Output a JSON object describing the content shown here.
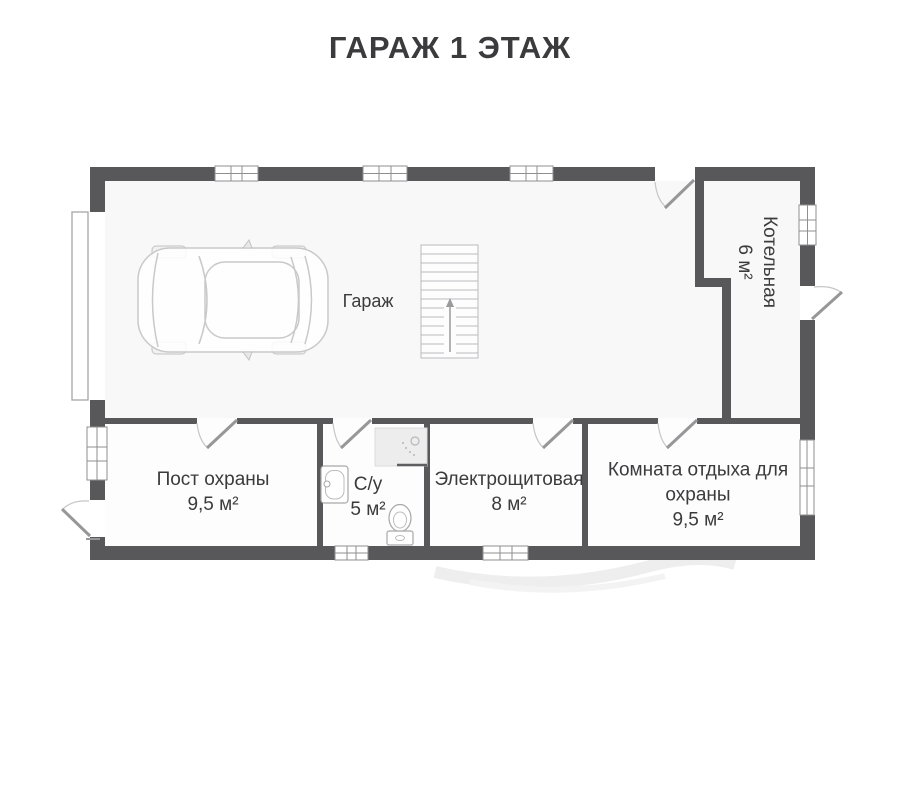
{
  "title": "ГАРАЖ 1 ЭТАЖ",
  "rooms": {
    "garage": {
      "label": "Гараж"
    },
    "boiler": {
      "label": "Котельная",
      "area": "6 м²"
    },
    "security_post": {
      "label": "Пост охраны",
      "area": "9,5 м²"
    },
    "bathroom": {
      "label": "С/у",
      "area": "5 м²"
    },
    "electrical": {
      "label": "Электрощитовая",
      "area": "8 м²"
    },
    "rest_room": {
      "label_line1": "Комната отдыха для",
      "label_line2": "охраны",
      "area": "9,5 м²"
    }
  },
  "colors": {
    "wall": "#58585a",
    "text": "#3b3b3d",
    "fixture": "#c7c7c9",
    "winline": "#8f8f91",
    "floor": "#f8f8f8"
  }
}
